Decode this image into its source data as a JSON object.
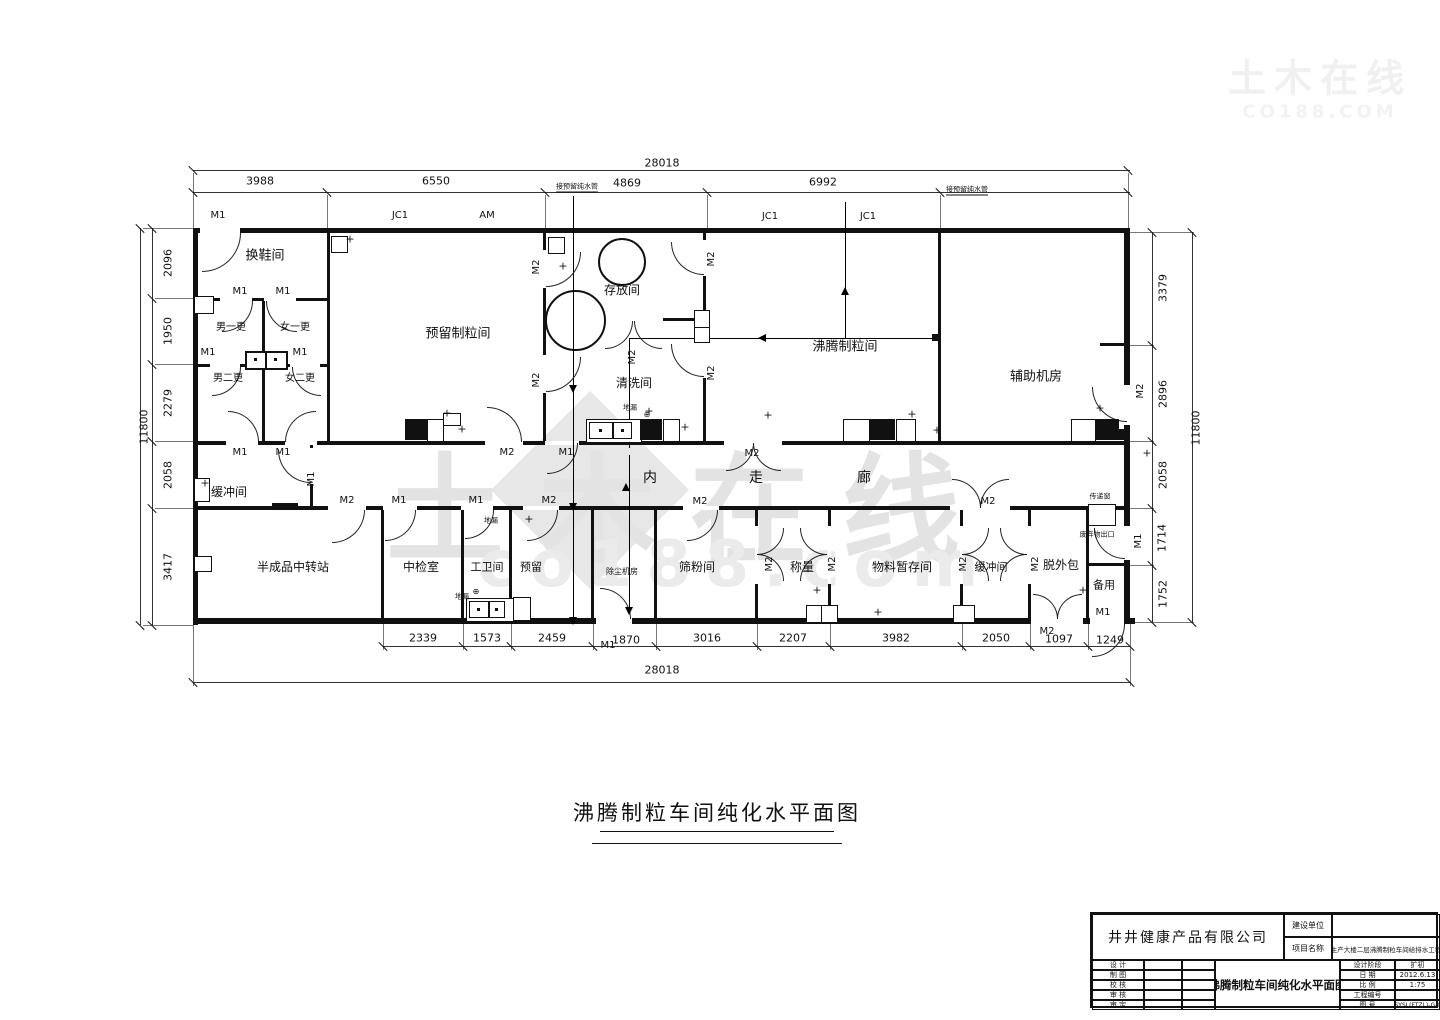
{
  "drawing_title": {
    "text": "沸腾制粒车间纯化水平面图"
  },
  "watermark": {
    "main": "土木在线",
    "sub": "co188.com",
    "corner1": "土木在线",
    "corner2": "CO188.COM"
  },
  "title_block": {
    "company": "井井健康产品有限公司",
    "owner_label": "建设单位",
    "owner_value": "",
    "project_label": "项目名称",
    "project_value": "生产大楼二层沸腾制粒车间给排水工程",
    "sign_rows": [
      "设  计",
      "制  图",
      "校  核",
      "审  核",
      "审  定"
    ],
    "drawing_title": "沸腾制粒车间纯化水平面图",
    "fields": [
      {
        "label": "设计阶段",
        "value": "扩初"
      },
      {
        "label": "日  期",
        "value": "2012.6.13"
      },
      {
        "label": "比  例",
        "value": "1:75"
      },
      {
        "label": "工程编号",
        "value": ""
      },
      {
        "label": "图  号",
        "value": "HSYSL(FTZL)-G-06"
      }
    ]
  },
  "labels": [
    {
      "n": "dim-total-top",
      "t": "28018",
      "x": 662,
      "y": 163,
      "s": 11
    },
    {
      "n": "dim",
      "t": "3988",
      "x": 260,
      "y": 181,
      "s": 11
    },
    {
      "n": "dim",
      "t": "6550",
      "x": 436,
      "y": 181,
      "s": 11
    },
    {
      "n": "dim",
      "t": "4869",
      "x": 627,
      "y": 183,
      "s": 11
    },
    {
      "n": "dim",
      "t": "6992",
      "x": 823,
      "y": 182,
      "s": 11
    },
    {
      "n": "pipe-note",
      "t": "接预留纯水管",
      "x": 577,
      "y": 188,
      "s": 7,
      "u": 1
    },
    {
      "n": "pipe-note",
      "t": "接预留纯水管",
      "x": 967,
      "y": 191,
      "s": 7,
      "u": 1
    },
    {
      "n": "door-label",
      "t": "M1",
      "x": 218,
      "y": 216,
      "s": 10
    },
    {
      "n": "window-label",
      "t": "JC1",
      "x": 400,
      "y": 216,
      "s": 10
    },
    {
      "n": "window-label",
      "t": "AM",
      "x": 487,
      "y": 216,
      "s": 10
    },
    {
      "n": "window-label",
      "t": "JC1",
      "x": 770,
      "y": 217,
      "s": 10
    },
    {
      "n": "window-label",
      "t": "JC1",
      "x": 868,
      "y": 217,
      "s": 10
    },
    {
      "n": "dim",
      "t": "2339",
      "x": 423,
      "y": 638,
      "s": 11
    },
    {
      "n": "dim",
      "t": "1573",
      "x": 487,
      "y": 638,
      "s": 11
    },
    {
      "n": "dim",
      "t": "2459",
      "x": 552,
      "y": 638,
      "s": 11
    },
    {
      "n": "dim",
      "t": "1870",
      "x": 626,
      "y": 640,
      "s": 11
    },
    {
      "n": "dim",
      "t": "3016",
      "x": 707,
      "y": 638,
      "s": 11
    },
    {
      "n": "dim",
      "t": "2207",
      "x": 793,
      "y": 638,
      "s": 11
    },
    {
      "n": "dim",
      "t": "3982",
      "x": 896,
      "y": 638,
      "s": 11
    },
    {
      "n": "dim",
      "t": "2050",
      "x": 996,
      "y": 638,
      "s": 11
    },
    {
      "n": "dim",
      "t": "1097",
      "x": 1059,
      "y": 639,
      "s": 11
    },
    {
      "n": "dim",
      "t": "1249",
      "x": 1110,
      "y": 640,
      "s": 11
    },
    {
      "n": "dim-total-bottom",
      "t": "28018",
      "x": 662,
      "y": 670,
      "s": 11
    },
    {
      "n": "door-label",
      "t": "M1",
      "x": 608,
      "y": 646,
      "s": 10
    },
    {
      "n": "door-label",
      "t": "M2",
      "x": 1047,
      "y": 632,
      "s": 10
    },
    {
      "n": "dim",
      "t": "2096",
      "x": 168,
      "y": 263,
      "s": 11,
      "r": 1
    },
    {
      "n": "dim",
      "t": "1950",
      "x": 168,
      "y": 331,
      "s": 11,
      "r": 1
    },
    {
      "n": "dim",
      "t": "2279",
      "x": 168,
      "y": 403,
      "s": 11,
      "r": 1
    },
    {
      "n": "dim",
      "t": "2058",
      "x": 168,
      "y": 475,
      "s": 11,
      "r": 1
    },
    {
      "n": "dim",
      "t": "3417",
      "x": 168,
      "y": 567,
      "s": 11,
      "r": 1
    },
    {
      "n": "dim-total-left",
      "t": "11800",
      "x": 144,
      "y": 427,
      "s": 11,
      "r": 1
    },
    {
      "n": "dim",
      "t": "3379",
      "x": 1163,
      "y": 288,
      "s": 11,
      "r": 1
    },
    {
      "n": "dim",
      "t": "2896",
      "x": 1163,
      "y": 394,
      "s": 11,
      "r": 1
    },
    {
      "n": "dim",
      "t": "2058",
      "x": 1163,
      "y": 475,
      "s": 11,
      "r": 1
    },
    {
      "n": "dim",
      "t": "1714",
      "x": 1162,
      "y": 538,
      "s": 11,
      "r": 1
    },
    {
      "n": "dim",
      "t": "1752",
      "x": 1163,
      "y": 594,
      "s": 11,
      "r": 1
    },
    {
      "n": "dim-total-right",
      "t": "11800",
      "x": 1196,
      "y": 428,
      "s": 11,
      "r": 1
    },
    {
      "n": "door-label",
      "t": "M2",
      "x": 1141,
      "y": 391,
      "s": 10,
      "r": 1
    },
    {
      "n": "door-label",
      "t": "M1",
      "x": 1139,
      "y": 541,
      "s": 10,
      "r": 1
    },
    {
      "n": "room-label",
      "t": "换鞋间",
      "x": 265,
      "y": 256,
      "s": 13
    },
    {
      "n": "room-label",
      "t": "男一更",
      "x": 231,
      "y": 328,
      "s": 10
    },
    {
      "n": "room-label",
      "t": "女一更",
      "x": 295,
      "y": 328,
      "s": 10
    },
    {
      "n": "room-label",
      "t": "男二更",
      "x": 228,
      "y": 379,
      "s": 10
    },
    {
      "n": "room-label",
      "t": "女二更",
      "x": 300,
      "y": 379,
      "s": 10
    },
    {
      "n": "room-label",
      "t": "预留制粒间",
      "x": 458,
      "y": 334,
      "s": 13
    },
    {
      "n": "room-label",
      "t": "存放间",
      "x": 622,
      "y": 290,
      "s": 12
    },
    {
      "n": "room-label",
      "t": "清洗间",
      "x": 634,
      "y": 383,
      "s": 12
    },
    {
      "n": "room-label",
      "t": "沸腾制粒间",
      "x": 845,
      "y": 347,
      "s": 13
    },
    {
      "n": "room-label",
      "t": "辅助机房",
      "x": 1036,
      "y": 377,
      "s": 13
    },
    {
      "n": "room-label",
      "t": "缓冲间",
      "x": 229,
      "y": 492,
      "s": 12
    },
    {
      "n": "room-label",
      "t": "内",
      "x": 650,
      "y": 478,
      "s": 14
    },
    {
      "n": "room-label",
      "t": "走",
      "x": 756,
      "y": 478,
      "s": 14
    },
    {
      "n": "room-label",
      "t": "廊",
      "x": 864,
      "y": 478,
      "s": 14
    },
    {
      "n": "room-label",
      "t": "半成品中转站",
      "x": 293,
      "y": 567,
      "s": 12
    },
    {
      "n": "room-label",
      "t": "中检室",
      "x": 421,
      "y": 567,
      "s": 12
    },
    {
      "n": "room-label",
      "t": "工卫间",
      "x": 487,
      "y": 567,
      "s": 11
    },
    {
      "n": "room-label",
      "t": "预留",
      "x": 531,
      "y": 567,
      "s": 11
    },
    {
      "n": "room-label",
      "t": "除尘机房",
      "x": 622,
      "y": 572,
      "s": 8
    },
    {
      "n": "room-label",
      "t": "筛粉间",
      "x": 697,
      "y": 567,
      "s": 12
    },
    {
      "n": "room-label",
      "t": "称量",
      "x": 802,
      "y": 567,
      "s": 12
    },
    {
      "n": "room-label",
      "t": "物料暂存间",
      "x": 902,
      "y": 567,
      "s": 12
    },
    {
      "n": "room-label",
      "t": "缓冲间",
      "x": 991,
      "y": 567,
      "s": 11
    },
    {
      "n": "room-label",
      "t": "脱外包",
      "x": 1061,
      "y": 565,
      "s": 12
    },
    {
      "n": "room-label",
      "t": "备用",
      "x": 1104,
      "y": 585,
      "s": 11
    },
    {
      "n": "drain-label",
      "t": "地漏",
      "x": 630,
      "y": 408,
      "s": 7
    },
    {
      "n": "drain-label",
      "t": "地漏",
      "x": 491,
      "y": 521,
      "s": 7
    },
    {
      "n": "drain-label",
      "t": "地漏",
      "x": 462,
      "y": 597,
      "s": 7
    },
    {
      "n": "drain-symbol",
      "t": "⊕",
      "x": 647,
      "y": 415,
      "s": 8
    },
    {
      "n": "drain-symbol",
      "t": "⊕",
      "x": 476,
      "y": 592,
      "s": 8
    },
    {
      "n": "pass-window-label",
      "t": "传递窗",
      "x": 1100,
      "y": 497,
      "s": 7
    },
    {
      "n": "waste-exit-label",
      "t": "废弃物出口",
      "x": 1097,
      "y": 535,
      "s": 7
    },
    {
      "n": "door-label",
      "t": "M1",
      "x": 240,
      "y": 292,
      "s": 10
    },
    {
      "n": "door-label",
      "t": "M1",
      "x": 283,
      "y": 292,
      "s": 10
    },
    {
      "n": "door-label",
      "t": "M1",
      "x": 208,
      "y": 353,
      "s": 10
    },
    {
      "n": "door-label",
      "t": "M1",
      "x": 300,
      "y": 353,
      "s": 10
    },
    {
      "n": "door-label",
      "t": "M1",
      "x": 240,
      "y": 453,
      "s": 10
    },
    {
      "n": "door-label",
      "t": "M1",
      "x": 283,
      "y": 453,
      "s": 10
    },
    {
      "n": "door-label",
      "t": "M1",
      "x": 312,
      "y": 479,
      "s": 10,
      "r": 1
    },
    {
      "n": "door-label",
      "t": "M2",
      "x": 537,
      "y": 267,
      "s": 10,
      "r": 1
    },
    {
      "n": "door-label",
      "t": "M2",
      "x": 537,
      "y": 380,
      "s": 10,
      "r": 1
    },
    {
      "n": "door-label",
      "t": "M2",
      "x": 507,
      "y": 453,
      "s": 10
    },
    {
      "n": "door-label",
      "t": "M1",
      "x": 566,
      "y": 453,
      "s": 10
    },
    {
      "n": "door-label",
      "t": "M2",
      "x": 633,
      "y": 357,
      "s": 10,
      "r": 1
    },
    {
      "n": "door-label",
      "t": "M2",
      "x": 712,
      "y": 259,
      "s": 10,
      "r": 1
    },
    {
      "n": "door-label",
      "t": "M2",
      "x": 712,
      "y": 373,
      "s": 10,
      "r": 1
    },
    {
      "n": "door-label",
      "t": "M2",
      "x": 752,
      "y": 454,
      "s": 10
    },
    {
      "n": "door-label",
      "t": "M2",
      "x": 347,
      "y": 501,
      "s": 10
    },
    {
      "n": "door-label",
      "t": "M1",
      "x": 399,
      "y": 501,
      "s": 10
    },
    {
      "n": "door-label",
      "t": "M1",
      "x": 476,
      "y": 501,
      "s": 10
    },
    {
      "n": "door-label",
      "t": "M2",
      "x": 549,
      "y": 501,
      "s": 10
    },
    {
      "n": "door-label",
      "t": "M2",
      "x": 700,
      "y": 502,
      "s": 10
    },
    {
      "n": "door-label",
      "t": "M2",
      "x": 988,
      "y": 502,
      "s": 10
    },
    {
      "n": "door-label",
      "t": "M2",
      "x": 770,
      "y": 564,
      "s": 10,
      "r": 1
    },
    {
      "n": "door-label",
      "t": "M2",
      "x": 833,
      "y": 564,
      "s": 10,
      "r": 1
    },
    {
      "n": "door-label",
      "t": "M2",
      "x": 964,
      "y": 564,
      "s": 10,
      "r": 1
    },
    {
      "n": "door-label",
      "t": "M2",
      "x": 1036,
      "y": 564,
      "s": 10,
      "r": 1
    },
    {
      "n": "door-label",
      "t": "M1",
      "x": 1103,
      "y": 613,
      "s": 10
    },
    {
      "n": "plus-mark",
      "t": "+",
      "x": 350,
      "y": 239,
      "s": 11
    },
    {
      "n": "plus-mark",
      "t": "+",
      "x": 563,
      "y": 266,
      "s": 11
    },
    {
      "n": "plus-mark",
      "t": "+",
      "x": 447,
      "y": 413,
      "s": 11
    },
    {
      "n": "plus-mark",
      "t": "+",
      "x": 462,
      "y": 429,
      "s": 11
    },
    {
      "n": "plus-mark",
      "t": "+",
      "x": 649,
      "y": 411,
      "s": 11
    },
    {
      "n": "plus-mark",
      "t": "+",
      "x": 685,
      "y": 427,
      "s": 11
    },
    {
      "n": "plus-mark",
      "t": "+",
      "x": 768,
      "y": 415,
      "s": 11
    },
    {
      "n": "plus-mark",
      "t": "+",
      "x": 912,
      "y": 414,
      "s": 11
    },
    {
      "n": "plus-mark",
      "t": "+",
      "x": 937,
      "y": 430,
      "s": 11
    },
    {
      "n": "plus-mark",
      "t": "+",
      "x": 1100,
      "y": 408,
      "s": 11
    },
    {
      "n": "plus-mark",
      "t": "+",
      "x": 1147,
      "y": 453,
      "s": 11
    },
    {
      "n": "plus-mark",
      "t": "+",
      "x": 817,
      "y": 590,
      "s": 11
    },
    {
      "n": "plus-mark",
      "t": "+",
      "x": 878,
      "y": 612,
      "s": 11
    },
    {
      "n": "plus-mark",
      "t": "+",
      "x": 1083,
      "y": 590,
      "s": 11
    },
    {
      "n": "plus-mark",
      "t": "+",
      "x": 205,
      "y": 483,
      "s": 11
    },
    {
      "n": "plus-mark",
      "t": "+",
      "x": 529,
      "y": 519,
      "s": 11
    }
  ]
}
